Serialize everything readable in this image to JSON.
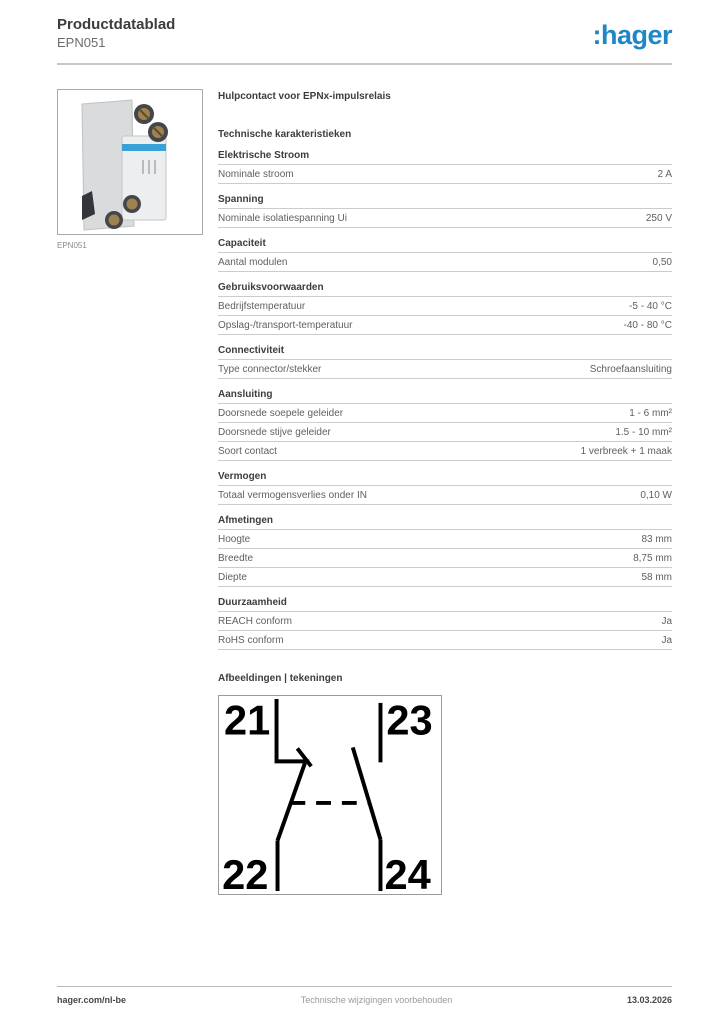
{
  "header": {
    "title": "Productdatablad",
    "product_code": "EPN051",
    "logo_text": ":hager",
    "logo_color": "#1e87c8"
  },
  "product": {
    "image_caption": "EPN051",
    "subtitle": "Hulpcontact voor EPNx-impulsrelais"
  },
  "sections_title": "Technische karakteristieken",
  "sections": [
    {
      "heading": "Elektrische Stroom",
      "rows": [
        {
          "label": "Nominale stroom",
          "value": "2 A"
        }
      ]
    },
    {
      "heading": "Spanning",
      "rows": [
        {
          "label": "Nominale isolatiespanning Ui",
          "value": "250 V"
        }
      ]
    },
    {
      "heading": "Capaciteit",
      "rows": [
        {
          "label": "Aantal modulen",
          "value": "0,50"
        }
      ]
    },
    {
      "heading": "Gebruiksvoorwaarden",
      "rows": [
        {
          "label": "Bedrijfstemperatuur",
          "value": "-5 - 40 °C"
        },
        {
          "label": "Opslag-/transport-temperatuur",
          "value": "-40 - 80 °C"
        }
      ]
    },
    {
      "heading": "Connectiviteit",
      "rows": [
        {
          "label": "Type connector/stekker",
          "value": "Schroefaansluiting"
        }
      ]
    },
    {
      "heading": "Aansluiting",
      "rows": [
        {
          "label": "Doorsnede soepele geleider",
          "value": "1 - 6 mm²"
        },
        {
          "label": "Doorsnede stijve geleider",
          "value": "1.5 - 10 mm²"
        },
        {
          "label": "Soort contact",
          "value": "1 verbreek + 1 maak"
        }
      ]
    },
    {
      "heading": "Vermogen",
      "rows": [
        {
          "label": "Totaal vermogensverlies onder IN",
          "value": "0,10 W"
        }
      ]
    },
    {
      "heading": "Afmetingen",
      "rows": [
        {
          "label": "Hoogte",
          "value": "83 mm"
        },
        {
          "label": "Breedte",
          "value": "8,75 mm"
        },
        {
          "label": "Diepte",
          "value": "58 mm"
        }
      ]
    },
    {
      "heading": "Duurzaamheid",
      "rows": [
        {
          "label": "REACH conform",
          "value": "Ja"
        },
        {
          "label": "RoHS conform",
          "value": "Ja"
        }
      ]
    }
  ],
  "drawings": {
    "heading": "Afbeeldingen | tekeningen",
    "terminals": {
      "top_left": "21",
      "top_right": "23",
      "bottom_left": "22",
      "bottom_right": "24"
    }
  },
  "footer": {
    "left": "hager.com/nl-be",
    "center": "Technische wijzigingen voorbehouden",
    "right": "13.03.2026"
  },
  "colors": {
    "brand_blue": "#1e87c8",
    "line_gray": "#cccccc",
    "text_dark": "#3d3d3d",
    "text_gray": "#606060"
  }
}
